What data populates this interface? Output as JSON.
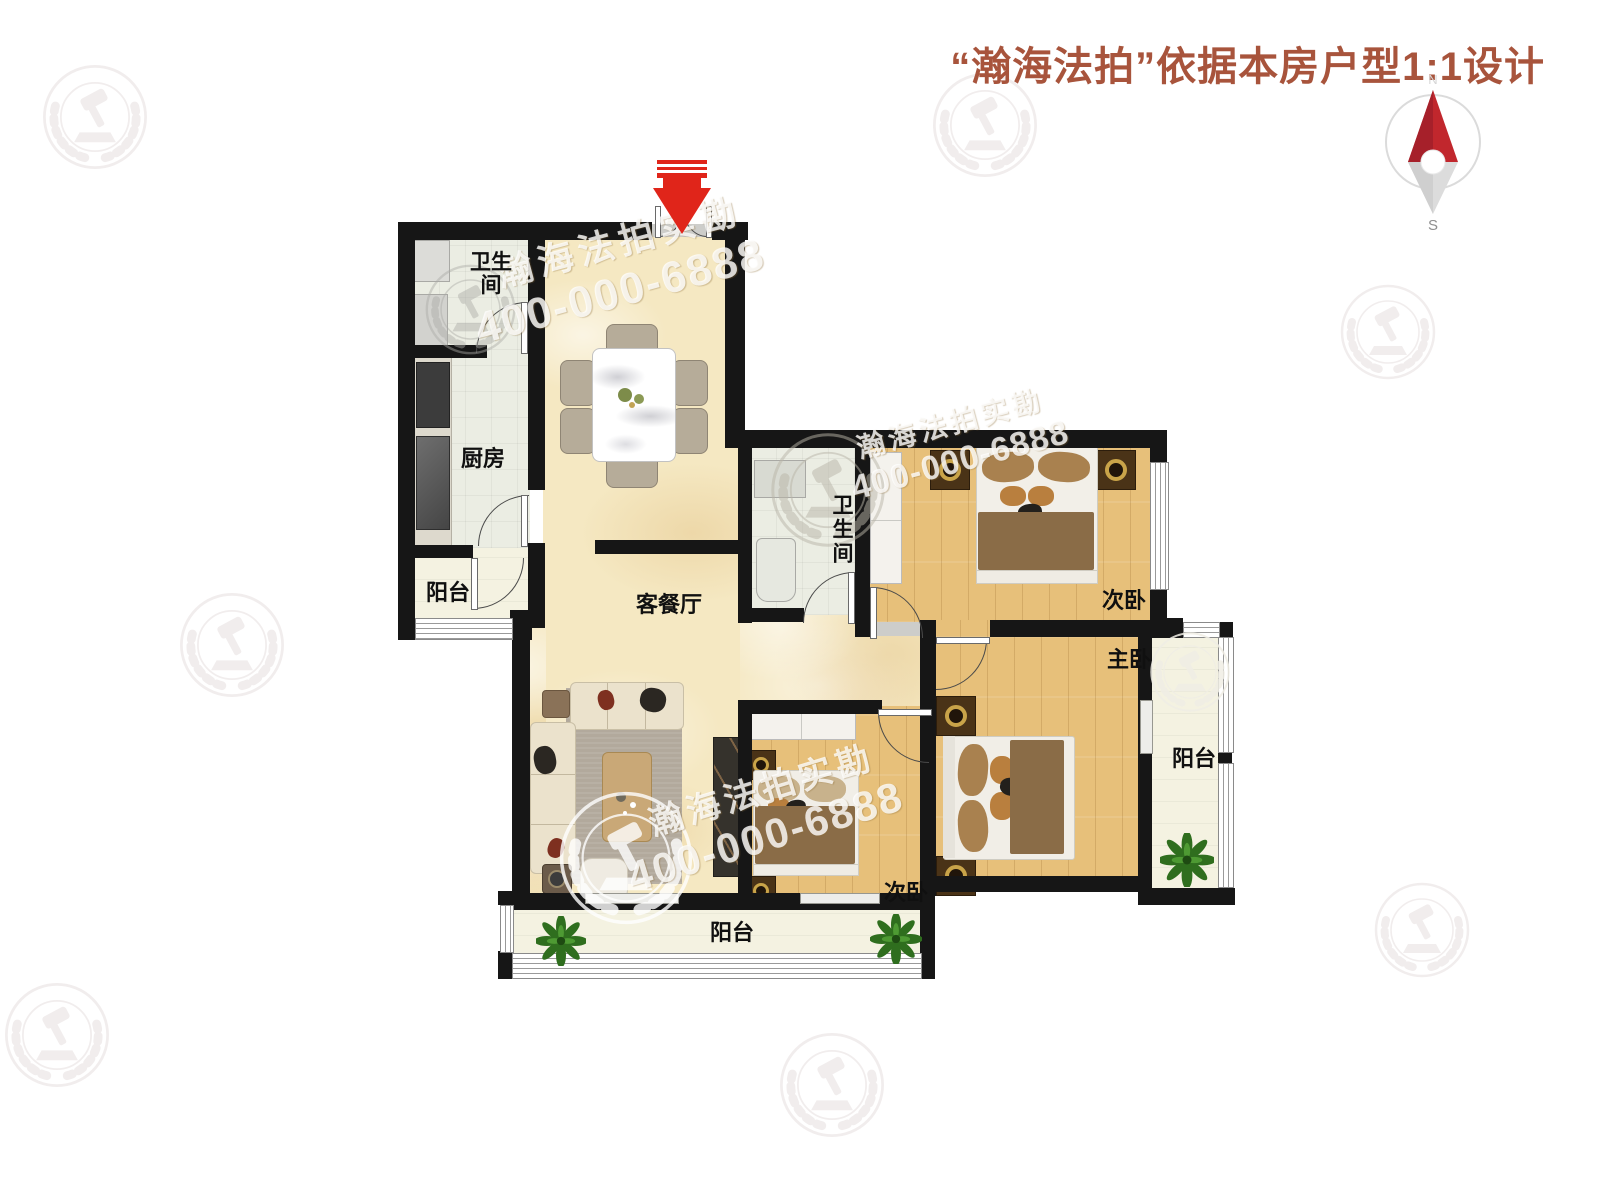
{
  "header": {
    "title": "“瀚海法拍”依据本房户型1:1设计"
  },
  "compass": {
    "north": "N",
    "south": "S",
    "needle_color": "#C1272D"
  },
  "rooms": {
    "bath_top": "卫生间",
    "kitchen": "厨房",
    "balcony_left": "阳台",
    "living": "客餐厅",
    "bath_mid": "卫生间",
    "bedroom_top_right": "次卧",
    "master": "主卧",
    "balcony_right": "阳台",
    "bedroom_bottom": "次卧",
    "balcony_bottom": "阳台"
  },
  "watermark": {
    "brand": "瀚海法拍实勘",
    "phone": "400-000-6888"
  },
  "colors": {
    "title": "#A8543C",
    "wall": "#161616",
    "entrance_arrow": "#E0251A",
    "compass_red": "#C1272D",
    "wood_floor": "#E7C07A",
    "marble_floor": "#F5E8C2",
    "tile_floor": "#EBEDE3",
    "balcony_floor": "#F4F2E1",
    "blanket_brown": "#8A6C47"
  }
}
